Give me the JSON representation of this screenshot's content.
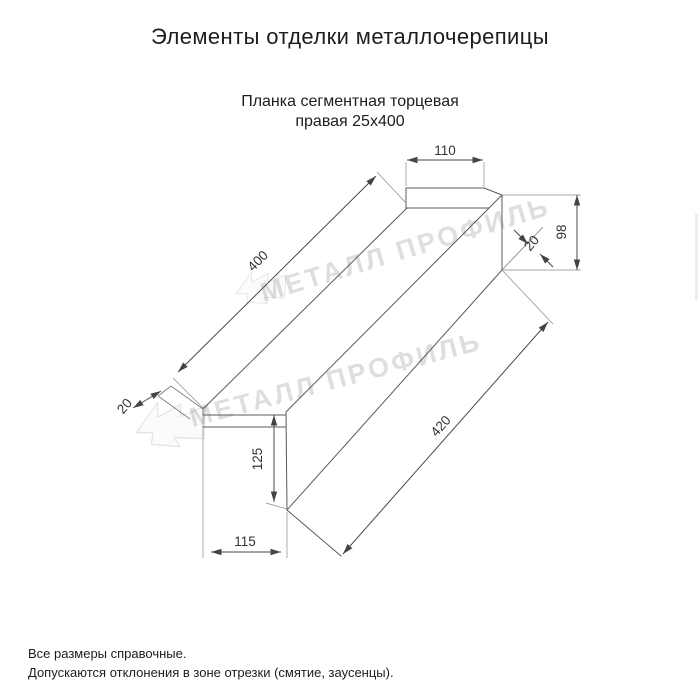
{
  "page": {
    "title": "Элементы отделки металлочерепицы"
  },
  "drawing": {
    "subtitle_line1": "Планка сегментная торцевая",
    "subtitle_line2": "правая 25х400",
    "dims": {
      "top_width": "110",
      "slope_length": "400",
      "end_height": "98",
      "end_hem": "20",
      "bottom_length": "420",
      "left_height": "125",
      "left_width": "115",
      "left_hem": "20"
    },
    "watermark": {
      "text": "МЕТАЛЛ ПРОФИЛЬ"
    }
  },
  "footer": {
    "note1": "Все размеры справочные.",
    "note2": "Допускаются отклонения в зоне отрезки (смятие, заусенцы)."
  }
}
